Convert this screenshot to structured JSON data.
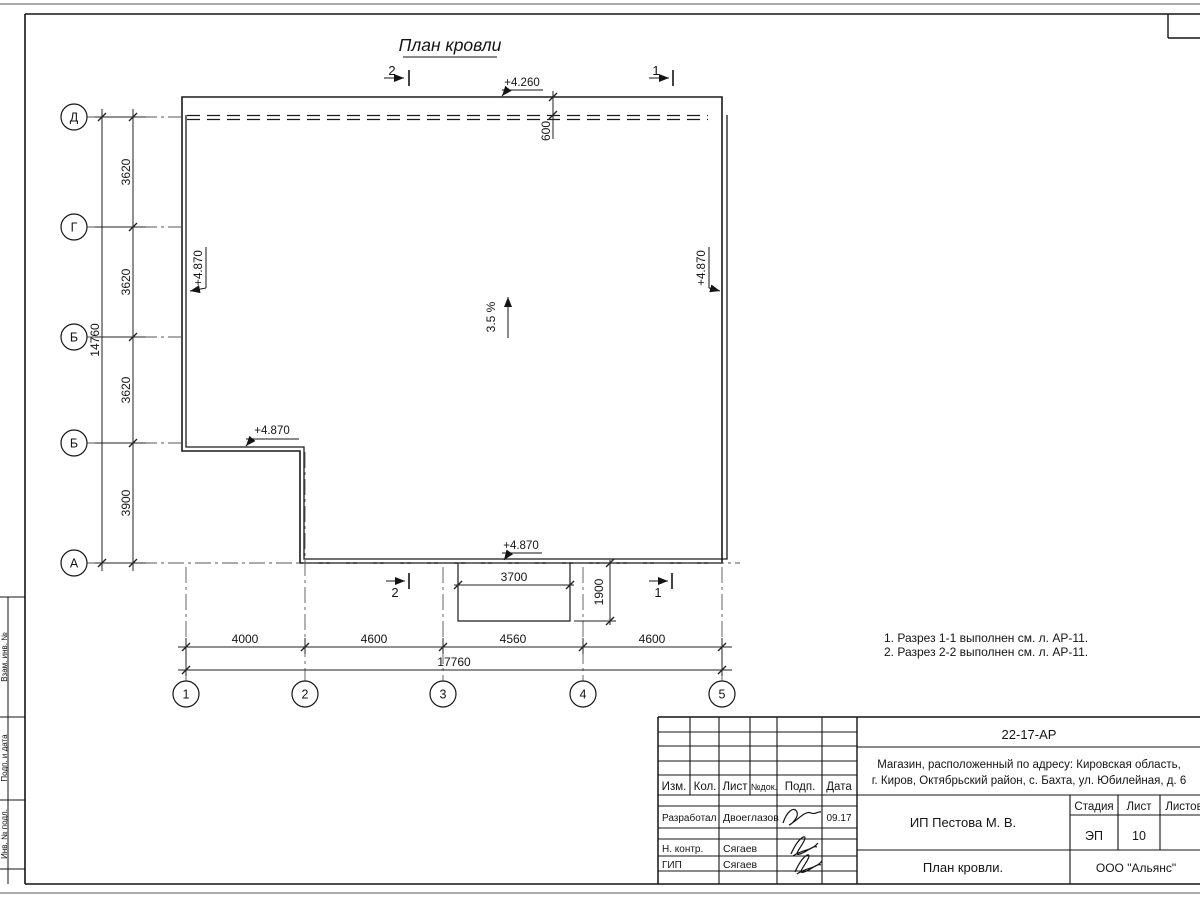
{
  "sheet": {
    "frame_strip": [
      "Взам. инв. №",
      "Подп. и дата",
      "Инв. № подл."
    ]
  },
  "plan": {
    "title": "План кровли",
    "slope_label": "3.5 %",
    "elev_top": "+4.260",
    "elev_left": "+4.870",
    "elev_right": "+4.870",
    "elev_step": "+4.870",
    "elev_bottom": "+4.870",
    "overhang_dim": "600",
    "axes_rows": [
      "Д",
      "Г",
      "Б",
      "Б",
      "А"
    ],
    "axes_cols": [
      "1",
      "2",
      "3",
      "4",
      "5"
    ],
    "dims_left": [
      "3620",
      "3620",
      "3620",
      "3900"
    ],
    "dim_left_total": "14760",
    "dims_bottom": [
      "4000",
      "4600",
      "4560",
      "4600"
    ],
    "dim_bottom_total": "17760",
    "canopy_width": "3700",
    "canopy_depth": "1900",
    "section_1": "1",
    "section_2": "2"
  },
  "notes": [
    "1. Разрез 1-1 выполнен см. л. АР-11.",
    "2. Разрез 2-2 выполнен см. л. АР-11."
  ],
  "titleblock": {
    "doc_code": "22-17-АР",
    "address_line1": "Магазин, расположенный по адресу: Кировская область,",
    "address_line2": "г. Киров, Октябрьский район, с. Бахта, ул. Юбилейная, д. 6",
    "col_izm": "Изм.",
    "col_kol": "Кол.",
    "col_list": "Лист",
    "col_ndok": "№док.",
    "col_podp": "Подп.",
    "col_data": "Дата",
    "row1_role": "Разработал",
    "row1_name": "Двоеглазов",
    "row1_date": "09.17",
    "row2_role": "Н. контр.",
    "row2_name": "Сягаев",
    "row3_role": "ГИП",
    "row3_name": "Сягаев",
    "client": "ИП Пестова М. В.",
    "stage_col": "Стадия",
    "list_col": "Лист",
    "listov_col": "Листов",
    "stage_value": "ЭП",
    "sheet_value": "10",
    "drawing_title": "План кровли.",
    "company": "ООО \"Альянс\""
  }
}
